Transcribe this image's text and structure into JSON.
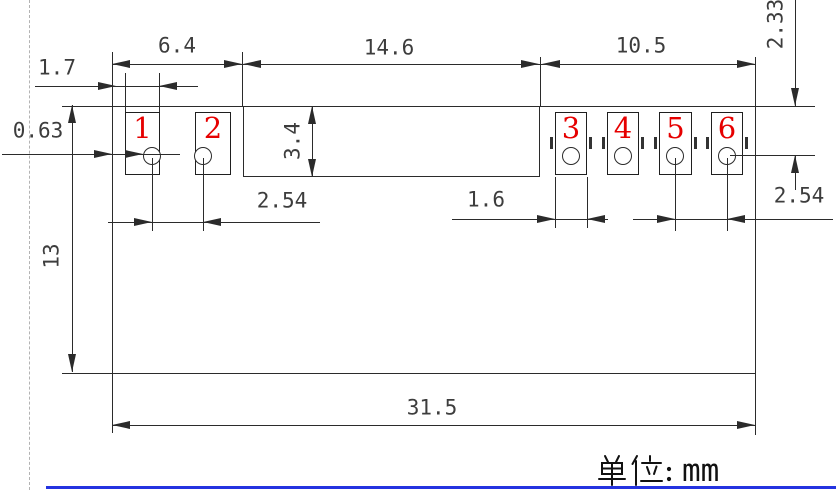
{
  "drawing": {
    "kind": "mechanical-dimension-drawing",
    "component": "6-pad solder footprint",
    "unit_note": {
      "full": "单位：mm",
      "prefix": "单位：",
      "units": "mm"
    },
    "pads": [
      {
        "number": "1"
      },
      {
        "number": "2"
      },
      {
        "number": "3"
      },
      {
        "number": "4"
      },
      {
        "number": "5"
      },
      {
        "number": "6"
      }
    ],
    "dims": {
      "left_group_span": "6.4",
      "center_section_span": "14.6",
      "right_group_span": "10.5",
      "pad_top_to_hole_center": "2.33",
      "left_pad_width": "1.7",
      "edge_to_pad_offset": "0.63",
      "notch_height": "3.4",
      "left_body_height": "13",
      "left_hole_pitch": "2.54",
      "right_pad_width": "1.6",
      "right_hole_pitch": "2.54",
      "overall_width": "31.5"
    },
    "colors": {
      "line": "#2b2b2b",
      "dim_text": "#3d3d3d",
      "pad_number": "#e60000",
      "bottom_rule": "#2433e0",
      "dashed": "#b3b3b3"
    }
  }
}
